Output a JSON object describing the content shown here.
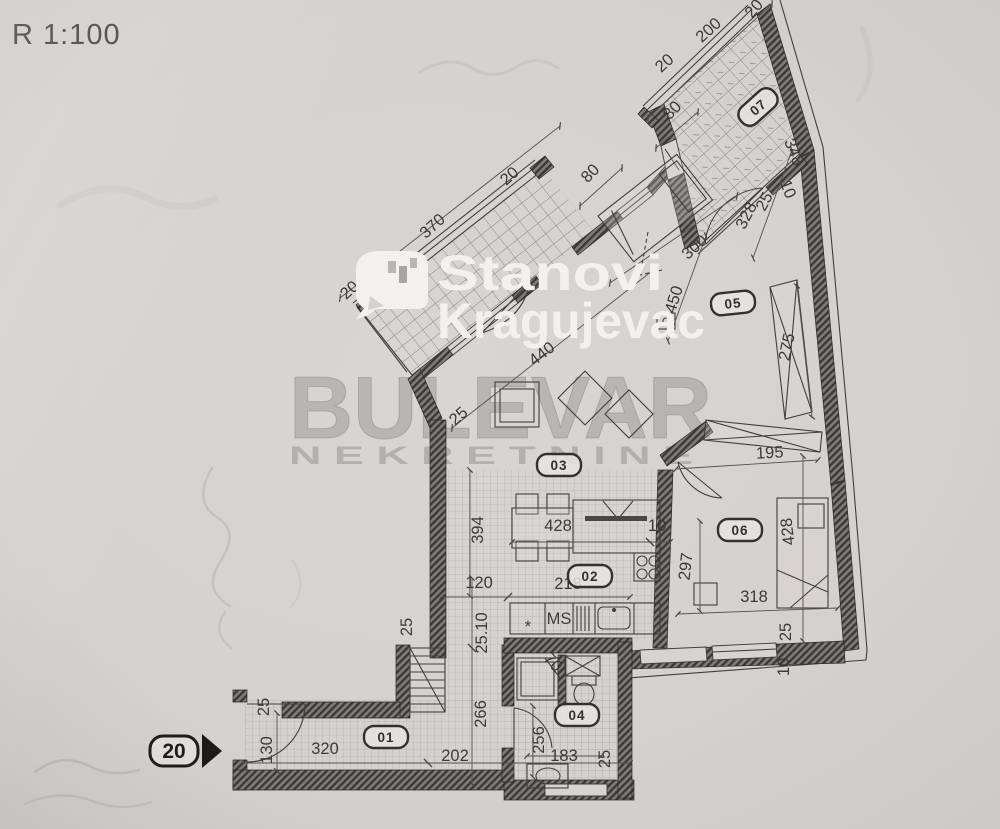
{
  "scale_label": "R 1:100",
  "watermark": {
    "brand_line1": "Stanovi",
    "brand_line2": "Kragujevac",
    "agency_name": "BULEVAR",
    "agency_subtitle": "N E K R E T N I N E"
  },
  "entrance_marker": {
    "number": "20"
  },
  "palette": {
    "paper": "#d4d2cd",
    "ink": "#3c3a35",
    "wall_dark": "#45433e",
    "watermark_white": "#f2f1ee",
    "watermark_gray": "#96948e"
  },
  "room_badges": [
    {
      "label": "01",
      "x": 386,
      "y": 737,
      "r": 0
    },
    {
      "label": "02",
      "x": 590,
      "y": 576,
      "r": 0
    },
    {
      "label": "03",
      "x": 559,
      "y": 465,
      "r": 0
    },
    {
      "label": "04",
      "x": 577,
      "y": 715,
      "r": 0
    },
    {
      "label": "05",
      "x": 733,
      "y": 303,
      "r": -6
    },
    {
      "label": "06",
      "x": 740,
      "y": 530,
      "r": 0
    },
    {
      "label": "07",
      "x": 758,
      "y": 107,
      "r": -42
    }
  ],
  "dimensions": [
    {
      "t": "20",
      "x": 758,
      "y": 12,
      "r": -50
    },
    {
      "t": "200",
      "x": 712,
      "y": 34,
      "r": -42
    },
    {
      "t": "20",
      "x": 668,
      "y": 67,
      "r": -42
    },
    {
      "t": "80",
      "x": 676,
      "y": 114,
      "r": -46,
      "s": 15
    },
    {
      "t": "348",
      "x": 789,
      "y": 154,
      "r": 68
    },
    {
      "t": "10",
      "x": 783,
      "y": 191,
      "r": 68,
      "s": 14
    },
    {
      "t": "25",
      "x": 769,
      "y": 204,
      "r": -62,
      "s": 13
    },
    {
      "t": "328",
      "x": 751,
      "y": 218,
      "r": -63
    },
    {
      "t": "300",
      "x": 698,
      "y": 251,
      "r": -42
    },
    {
      "t": "450",
      "x": 679,
      "y": 301,
      "r": -73
    },
    {
      "t": "80",
      "x": 594,
      "y": 177,
      "r": -46,
      "s": 15
    },
    {
      "t": "370",
      "x": 436,
      "y": 230,
      "r": -42
    },
    {
      "t": "20",
      "x": 513,
      "y": 180,
      "r": -42
    },
    {
      "t": "20",
      "x": 353,
      "y": 294,
      "r": -42
    },
    {
      "t": "440",
      "x": 545,
      "y": 358,
      "r": -38
    },
    {
      "t": "25",
      "x": 462,
      "y": 420,
      "r": -42,
      "s": 14
    },
    {
      "t": "275",
      "x": 792,
      "y": 348,
      "r": -78
    },
    {
      "t": "195",
      "x": 770,
      "y": 458,
      "r": -3
    },
    {
      "t": "394",
      "x": 483,
      "y": 530,
      "r": -90
    },
    {
      "t": "428",
      "x": 558,
      "y": 531,
      "r": 0
    },
    {
      "t": "10",
      "x": 657,
      "y": 531,
      "r": 0,
      "s": 14
    },
    {
      "t": "120",
      "x": 479,
      "y": 588,
      "r": 0
    },
    {
      "t": "218",
      "x": 568,
      "y": 589,
      "r": 0
    },
    {
      "t": "297",
      "x": 691,
      "y": 567,
      "r": -84
    },
    {
      "t": "318",
      "x": 754,
      "y": 602,
      "r": 0
    },
    {
      "t": "428",
      "x": 793,
      "y": 531,
      "r": -97
    },
    {
      "t": "25",
      "x": 791,
      "y": 632,
      "r": -90,
      "s": 14
    },
    {
      "t": "10",
      "x": 789,
      "y": 667,
      "r": -90,
      "s": 14
    },
    {
      "t": "MS",
      "x": 559,
      "y": 624,
      "r": 0,
      "s": 13
    },
    {
      "t": "*",
      "x": 528,
      "y": 632,
      "r": 0,
      "s": 26
    },
    {
      "t": "25.10",
      "x": 487,
      "y": 633,
      "r": -90,
      "s": 14
    },
    {
      "t": "25",
      "x": 412,
      "y": 627,
      "r": -90,
      "s": 13
    },
    {
      "t": "266",
      "x": 486,
      "y": 714,
      "r": -90
    },
    {
      "t": "25",
      "x": 269,
      "y": 707,
      "r": -90,
      "s": 12
    },
    {
      "t": "130",
      "x": 272,
      "y": 750,
      "r": -90
    },
    {
      "t": "320",
      "x": 325,
      "y": 754,
      "r": 0
    },
    {
      "t": "202",
      "x": 455,
      "y": 761,
      "r": 0
    },
    {
      "t": "256",
      "x": 544,
      "y": 740,
      "r": -90
    },
    {
      "t": "183",
      "x": 564,
      "y": 761,
      "r": 0
    },
    {
      "t": "25",
      "x": 610,
      "y": 759,
      "r": -90,
      "s": 13
    },
    {
      "t": "70",
      "x": 549,
      "y": 666,
      "r": 48,
      "s": 13
    }
  ]
}
